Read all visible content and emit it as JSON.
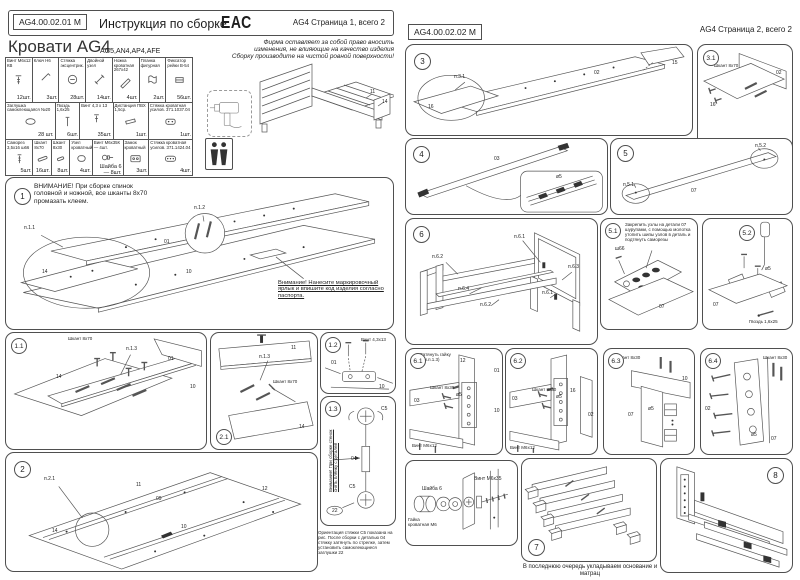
{
  "p1": {
    "header": {
      "doc_code": "AG4.00.02.01 М",
      "title": "Инструкция по сборке",
      "eac": "ЕАС",
      "page_info": "AG4 Страница 1, всего 2"
    },
    "product": {
      "title": "Кровати AG4",
      "models": "AG5,AN4,AP4,AFE",
      "note1": "Фирма оставляет за собой право вносить изменения, не влияющие на качество изделия",
      "note2": "Сборку производите на чистой ровной поверхности!"
    },
    "table": {
      "r0": [
        {
          "n": "Винт М6х12 КВ",
          "q": "12шт."
        },
        {
          "n": "Ключ Н6",
          "q": "3шт."
        },
        {
          "n": "Стяжка эксцентрик.",
          "q": "28шт."
        },
        {
          "n": "Двойной узел",
          "q": "14шт."
        },
        {
          "n": "Ножка кроватная 267х42",
          "q": "4шт."
        },
        {
          "n": "Планка фигурная",
          "q": "2шт."
        },
        {
          "n": "Фиксатор рейки В-54",
          "q": "56шт."
        }
      ],
      "r1": [
        {
          "n": "Заглушка самоклеющаяся №20",
          "q": "28 шт."
        },
        {
          "n": "Гвоздь 1,6х25",
          "q": "6шт."
        },
        {
          "n": "Винт 4,3 х 13",
          "q": "35шт."
        },
        {
          "n": "Дистанция ПВХ 1,5ср.",
          "q": "1шт."
        },
        {
          "n": "Стяжка кроватная усилов. 371.1037.04",
          "q": "1шт."
        }
      ],
      "r2": [
        {
          "n": "Саморез 3,5х16 ш66",
          "q": "5шт."
        },
        {
          "n": "Шкант 8х70",
          "q": "16шт."
        },
        {
          "n": "Шкант 8х30",
          "q": "8шт."
        },
        {
          "n": "Узел кроватный",
          "q": "4шт."
        },
        {
          "n": "Винт М6х35К — 4шт.",
          "q": "Шайба 6 — 8шт."
        },
        {
          "n": "Замок кроватный",
          "q": "3шт."
        },
        {
          "n": "Стяжка кроватная усилов. 371.1424.04",
          "q": "4шт."
        }
      ]
    },
    "bed": {
      "l11": "11",
      "l14": "14"
    },
    "s1": {
      "num": "1",
      "warning": "ВНИМАНИЕ! При сборке спинок головной и ножной, все шканты 8х70 промазать клеем.",
      "note": "Внимание! Нанесите маркировочный ярлык и впишите код изделия согласно паспорта.",
      "p11": "п.1.1",
      "p12": "п.1.2",
      "l01": "01",
      "l10": "10",
      "l14": "14"
    },
    "s11": {
      "num": "1.1",
      "dowel": "Шкант 8х70",
      "p13": "п.1.3",
      "l01": "01",
      "l10": "10",
      "l14": "14"
    },
    "s21": {
      "num": "2.1",
      "l11": "11",
      "p13": "п.1.3",
      "dowel": "Шкант 8х70",
      "l14": "14"
    },
    "s12": {
      "num": "1.2",
      "screw": "Винт 4,3х13",
      "l01": "01",
      "l10": "10"
    },
    "s13": {
      "num": "1.3",
      "side": "Внимание! При сборке стенок снять плёнку с деталей",
      "c5a": "С5",
      "c5b": "С5",
      "l04": "04",
      "l22": "22",
      "caption": "Ориентация стяжки С5 показана на рис. После сборки с деталью 04 стяжку затянуть по стрелке, затем установить самоклеющиеся заглушки 22"
    },
    "s2": {
      "num": "2",
      "p21": "п.2.1",
      "l11": "11",
      "l09": "09",
      "l10": "10",
      "l12": "12",
      "l14": "14"
    }
  },
  "p2": {
    "header": {
      "doc_code": "AG4.00.02.02 М",
      "page_info": "AG4 Страница 2, всего 2"
    },
    "s3": {
      "num": "3",
      "p31": "п.3.1",
      "l02": "02",
      "l15": "15",
      "l16": "16"
    },
    "s31": {
      "num": "3.1",
      "dowel": "Шкант 8х70",
      "l02": "02",
      "l16": "16"
    },
    "s4": {
      "num": "4",
      "l03": "03",
      "d5": "ø5"
    },
    "s5": {
      "num": "5",
      "p51": "п.5.1",
      "p52": "п.5.2",
      "l07": "07"
    },
    "s51": {
      "num": "5.1",
      "note": "Закрепить узлы на детали 07 шурупами, с помощью молотка утопить шипы узлов в деталь и подтянуть саморезы",
      "sh66": "ш66",
      "l07": "07"
    },
    "s52": {
      "num": "5.2",
      "d5": "ø5",
      "l07": "07",
      "nail": "Гвоздь 1,6х25"
    },
    "s6": {
      "num": "6",
      "p61a": "п.6.1",
      "p61b": "п.6.1",
      "p62a": "п.6.2",
      "p62b": "п.6.2",
      "p63": "п.6.3",
      "p64": "п.6.4"
    },
    "s61": {
      "num": "6.1",
      "note": "Затянуть гайку (см.п.1.3)",
      "l12": "12",
      "l01": "01",
      "l03": "03",
      "l10": "10",
      "dowel": "Шкант 8х30",
      "d5": "ø5",
      "screw": "Винт М6х12"
    },
    "s62": {
      "num": "6.2",
      "l03": "03",
      "l16": "16",
      "l02": "02",
      "dowel": "Шкант 8х30",
      "d5": "ø5",
      "screw": "Винт М6х12"
    },
    "s63": {
      "num": "6.3",
      "dowel": "Шкант 8х30",
      "l10": "10",
      "l07": "07",
      "d5": "ø5"
    },
    "s64": {
      "num": "6.4",
      "dowel": "Шкант 8х30",
      "l02": "02",
      "l07": "07",
      "d5": "ø5"
    },
    "sb": {
      "washer": "Шайба 6",
      "bolt": "Винт М6х35",
      "nut": "Гайка кроватная М6"
    },
    "s7": {
      "num": "7",
      "caption": "В последнюю очередь укладываем основание и матрац"
    },
    "s8": {
      "num": "8"
    }
  }
}
